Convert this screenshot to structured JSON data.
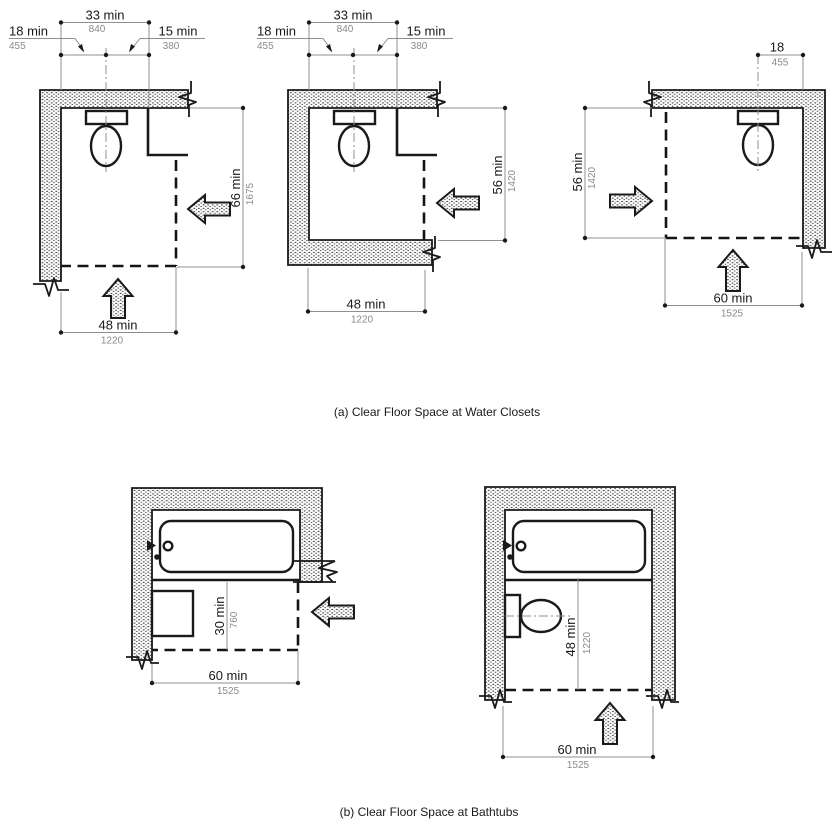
{
  "colors": {
    "line": "#1a1a1a",
    "dimension_line": "#8f8f8f",
    "metric_text": "#8a8a8a",
    "background": "#ffffff"
  },
  "captions": {
    "a": "(a) Clear Floor Space at Water Closets",
    "b": "(b) Clear Floor Space at Bathtubs"
  },
  "water_closets": {
    "adjacent_wall": {
      "centerline_width": {
        "imperial": "33 min",
        "metric": "840"
      },
      "centerline_to_wall": {
        "imperial": "18 min",
        "metric": "455"
      },
      "centerline_to_obstruction": {
        "imperial": "15 min",
        "metric": "380"
      },
      "clearance_depth": {
        "imperial": "66 min",
        "metric": "1675"
      },
      "clearance_width": {
        "imperial": "48 min",
        "metric": "1220"
      }
    },
    "facing_wall": {
      "centerline_width": {
        "imperial": "33 min",
        "metric": "840"
      },
      "centerline_to_wall": {
        "imperial": "18 min",
        "metric": "455"
      },
      "centerline_to_obstruction": {
        "imperial": "15 min",
        "metric": "380"
      },
      "clearance_depth": {
        "imperial": "56 min",
        "metric": "1420"
      },
      "clearance_width": {
        "imperial": "48 min",
        "metric": "1220"
      }
    },
    "corner": {
      "centerline_to_wall": {
        "imperial": "18",
        "metric": "455"
      },
      "clearance_depth": {
        "imperial": "56 min",
        "metric": "1420"
      },
      "clearance_width": {
        "imperial": "60 min",
        "metric": "1525"
      }
    }
  },
  "bathtubs": {
    "with_lavatory": {
      "clearance_depth": {
        "imperial": "30 min",
        "metric": "760"
      },
      "clearance_width": {
        "imperial": "60 min",
        "metric": "1525"
      }
    },
    "with_water_closet": {
      "clearance_depth": {
        "imperial": "48 min",
        "metric": "1220"
      },
      "clearance_width": {
        "imperial": "60 min",
        "metric": "1525"
      }
    }
  }
}
